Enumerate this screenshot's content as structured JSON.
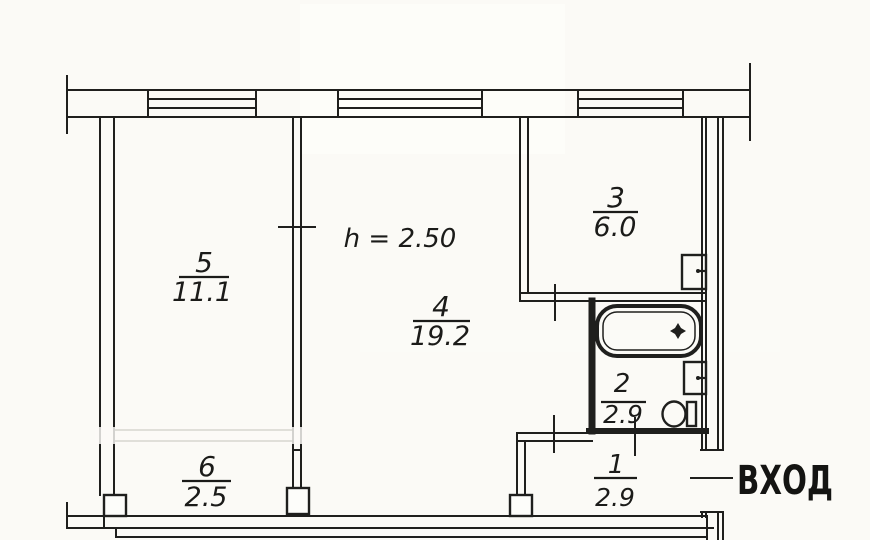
{
  "plan": {
    "type": "apartment-floor-plan",
    "ceiling_height_label": "h = 2.50",
    "entrance_label": "ВХОД",
    "rooms": [
      {
        "id": "room-5",
        "number": "5",
        "area": "11.1"
      },
      {
        "id": "room-4",
        "number": "4",
        "area": "19.2"
      },
      {
        "id": "room-3",
        "number": "3",
        "area": "6.0"
      },
      {
        "id": "room-2",
        "number": "2",
        "area": "2.9"
      },
      {
        "id": "room-1",
        "number": "1",
        "area": "2.9"
      },
      {
        "id": "room-6",
        "number": "6",
        "area": "2.5"
      }
    ],
    "fixtures": [
      "bathtub",
      "bathroom-sink",
      "toilet",
      "kitchen-sink"
    ],
    "line_color": "#1f1f1d",
    "paper_color": "#fbfaf6"
  }
}
